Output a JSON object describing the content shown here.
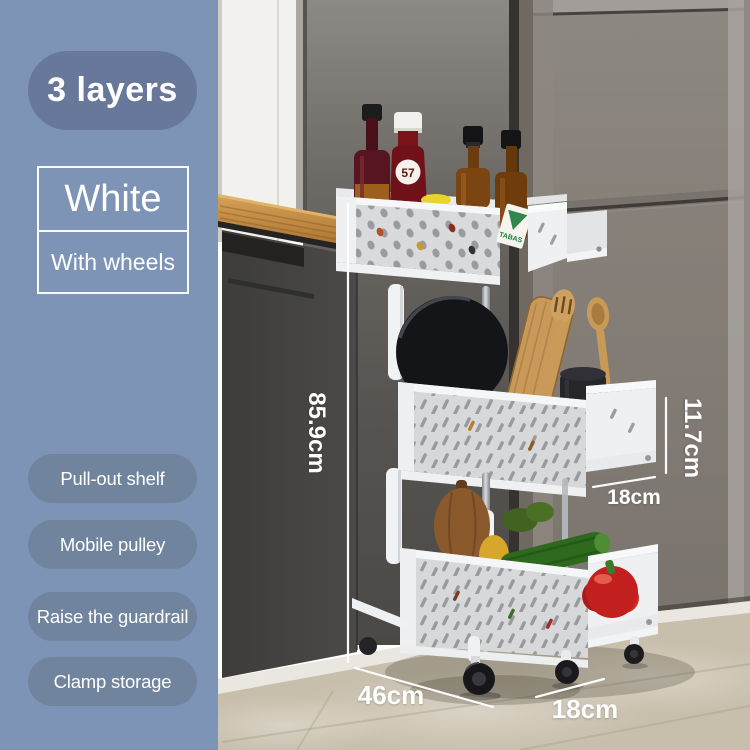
{
  "product_card": {
    "layers_badge": "3 layers",
    "variant": {
      "color": "White",
      "wheels": "With wheels"
    },
    "features": [
      "Pull-out shelf",
      "Mobile pulley",
      "Raise the guardrail",
      "Clamp storage"
    ],
    "dimensions": {
      "total_height": "85.9cm",
      "tier_height": "11.7cm",
      "tier_depth": "18cm",
      "floor_length": "46cm",
      "floor_depth": "18cm"
    },
    "scene_text": {
      "ketchup_cap_label": "57",
      "sauce_box_label": "TABAS"
    }
  },
  "colors": {
    "panel_blue": "#7D94B6",
    "layers_badge_bg": "#68789A",
    "feature_pill_bg": "#71849E",
    "label_text": "#FFFFFF",
    "dimension_text": "#FFFFFF"
  }
}
